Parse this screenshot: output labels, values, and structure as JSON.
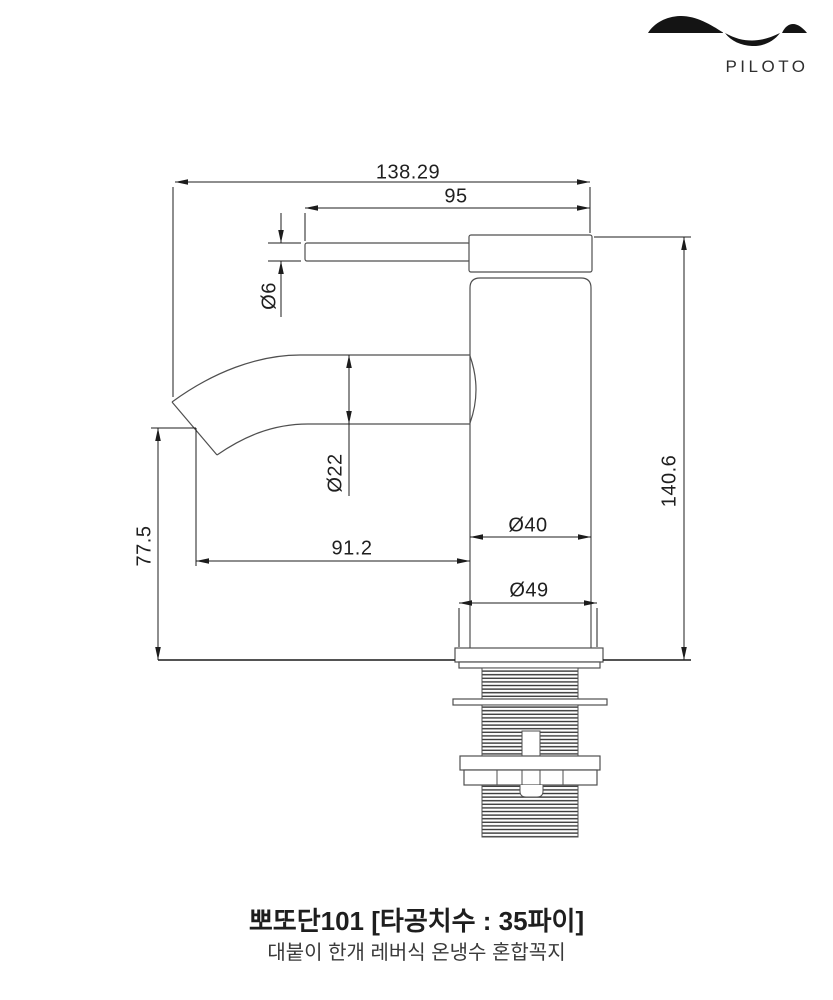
{
  "brand": {
    "name": "PILOTO"
  },
  "product": {
    "title": "뽀또단101 [타공치수 : 35파이]",
    "subtitle": "대붙이 한개 레버식 온냉수 혼합꼭지"
  },
  "dimensions": {
    "overall_length": "138.29",
    "handle_span": "95",
    "lever_dia": "Ø6",
    "spout_dia": "Ø22",
    "outlet_height": "77.5",
    "spout_reach": "91.2",
    "body_dia": "Ø40",
    "base_dia": "Ø49",
    "overall_height": "140.6"
  },
  "colors": {
    "object_line": "#4f4f4f",
    "dimension_line": "#1c1c1c",
    "text": "#1f1f1f"
  }
}
